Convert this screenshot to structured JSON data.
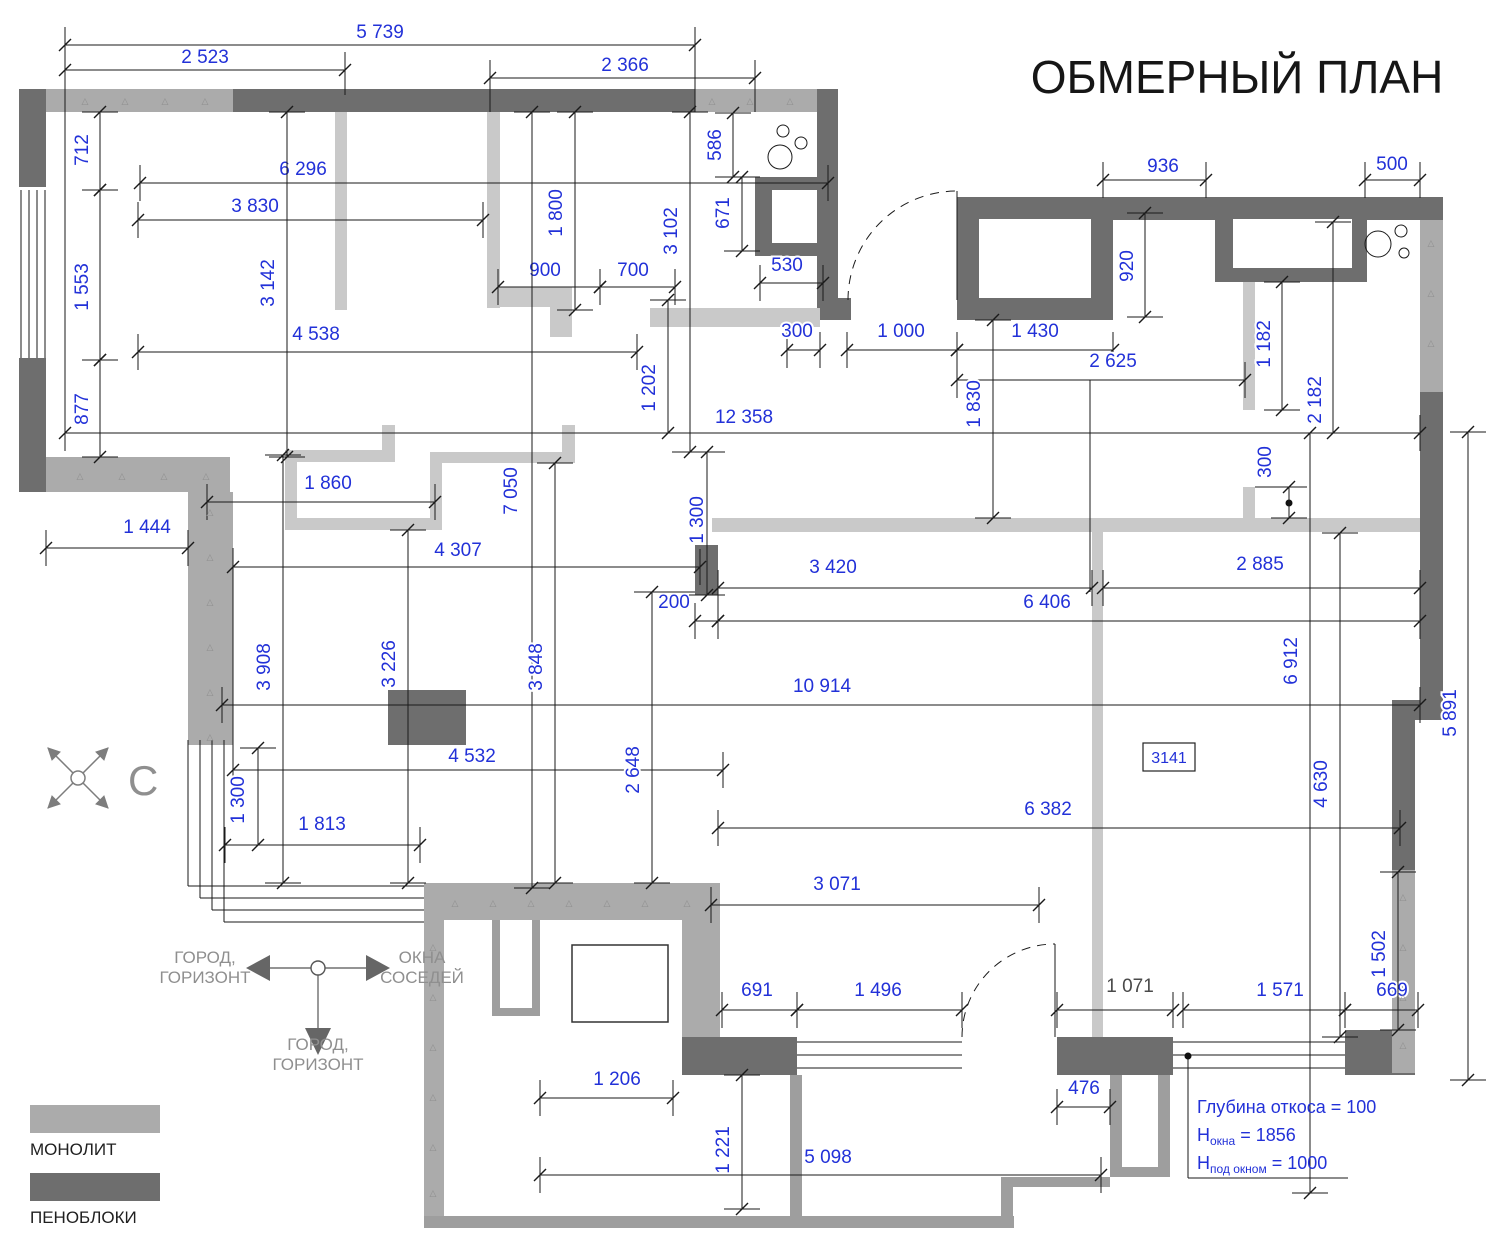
{
  "title": "ОБМЕРНЫЙ ПЛАН",
  "compass": {
    "north_label": "С"
  },
  "orientation_symbol": {
    "left_label_line1": "ГОРОД,",
    "left_label_line2": "ГОРИЗОНТ",
    "right_label_line1": "ОКНА",
    "right_label_line2": "СОСЕДЕЙ",
    "bottom_label_line1": "ГОРОД,",
    "bottom_label_line2": "ГОРИЗОНТ"
  },
  "legend": {
    "monolith_label": "МОНОЛИТ",
    "foamblock_label": "ПЕНОБЛОКИ"
  },
  "room_tag": "3141",
  "notes": [
    {
      "pre": "Глубина откоса = 100",
      "sub": "",
      "post": ""
    },
    {
      "pre": "Н",
      "sub": "окна",
      "post": " = 1856"
    },
    {
      "pre": "Н",
      "sub": "под окном",
      "post": " = 1000"
    }
  ],
  "colors": {
    "dimension_blue": "#2231d8",
    "dark_dim": "#4a4a4a",
    "monolith_gray": "#ababab",
    "foam_gray": "#6e6e6e",
    "partition_gray": "#c9c9c9",
    "balcony_gray": "#9e9e9e",
    "symbol_gray": "#8f8f8f"
  },
  "dimensions": [
    {
      "t": "5 739",
      "x1": 65,
      "y1": 45,
      "x2": 695,
      "y2": 45,
      "tx": 380,
      "ty": 38,
      "r": 0
    },
    {
      "t": "2 523",
      "x1": 65,
      "y1": 70,
      "x2": 345,
      "y2": 70,
      "tx": 205,
      "ty": 63,
      "r": 0
    },
    {
      "t": "2 366",
      "x1": 490,
      "y1": 78,
      "x2": 755,
      "y2": 78,
      "tx": 625,
      "ty": 71,
      "r": 0
    },
    {
      "t": "6 296",
      "x1": 140,
      "y1": 183,
      "x2": 828,
      "y2": 183,
      "tx": 303,
      "ty": 175,
      "r": 0
    },
    {
      "t": "3 830",
      "x1": 138,
      "y1": 220,
      "x2": 483,
      "y2": 220,
      "tx": 255,
      "ty": 212,
      "r": 0
    },
    {
      "t": "936",
      "x1": 1103,
      "y1": 180,
      "x2": 1206,
      "y2": 180,
      "tx": 1163,
      "ty": 172,
      "r": 0
    },
    {
      "t": "500",
      "x1": 1365,
      "y1": 180,
      "x2": 1420,
      "y2": 180,
      "tx": 1392,
      "ty": 170,
      "r": 0
    },
    {
      "t": "900",
      "x1": 498,
      "y1": 287,
      "x2": 600,
      "y2": 287,
      "tx": 545,
      "ty": 276,
      "r": 0
    },
    {
      "t": "700",
      "x1": 600,
      "y1": 287,
      "x2": 675,
      "y2": 287,
      "tx": 633,
      "ty": 276,
      "r": 0
    },
    {
      "t": "530",
      "x1": 760,
      "y1": 283,
      "x2": 823,
      "y2": 283,
      "tx": 787,
      "ty": 271,
      "r": 0
    },
    {
      "t": "4 538",
      "x1": 138,
      "y1": 352,
      "x2": 637,
      "y2": 352,
      "tx": 316,
      "ty": 340,
      "r": 0
    },
    {
      "t": "300",
      "x1": 787,
      "y1": 350,
      "x2": 820,
      "y2": 350,
      "tx": 797,
      "ty": 337,
      "r": 0
    },
    {
      "t": "1 000",
      "x1": 847,
      "y1": 350,
      "x2": 957,
      "y2": 350,
      "tx": 901,
      "ty": 337,
      "r": 0
    },
    {
      "t": "1 430",
      "x1": 957,
      "y1": 350,
      "x2": 1113,
      "y2": 350,
      "tx": 1035,
      "ty": 337,
      "r": 0
    },
    {
      "t": "2 625",
      "x1": 957,
      "y1": 380,
      "x2": 1245,
      "y2": 380,
      "tx": 1113,
      "ty": 367,
      "r": 0
    },
    {
      "t": "12 358",
      "x1": 65,
      "y1": 433,
      "x2": 1420,
      "y2": 433,
      "tx": 744,
      "ty": 423,
      "r": 0
    },
    {
      "t": "1 860",
      "x1": 207,
      "y1": 502,
      "x2": 435,
      "y2": 502,
      "tx": 328,
      "ty": 489,
      "r": 0
    },
    {
      "t": "1 444",
      "x1": 46,
      "y1": 548,
      "x2": 188,
      "y2": 548,
      "tx": 147,
      "ty": 533,
      "r": 0
    },
    {
      "t": "4 307",
      "x1": 233,
      "y1": 567,
      "x2": 700,
      "y2": 567,
      "tx": 458,
      "ty": 556,
      "r": 0
    },
    {
      "t": "3 420",
      "x1": 718,
      "y1": 588,
      "x2": 1092,
      "y2": 588,
      "tx": 833,
      "ty": 573,
      "r": 0
    },
    {
      "t": "2 885",
      "x1": 1103,
      "y1": 588,
      "x2": 1420,
      "y2": 588,
      "tx": 1260,
      "ty": 570,
      "r": 0
    },
    {
      "t": "200",
      "x1": 695,
      "y1": 621,
      "x2": 718,
      "y2": 621,
      "tx": 674,
      "ty": 608,
      "r": 0
    },
    {
      "t": "6 406",
      "x1": 718,
      "y1": 621,
      "x2": 1420,
      "y2": 621,
      "tx": 1047,
      "ty": 608,
      "r": 0
    },
    {
      "t": "10 914",
      "x1": 222,
      "y1": 705,
      "x2": 1420,
      "y2": 705,
      "tx": 822,
      "ty": 692,
      "r": 0
    },
    {
      "t": "4 532",
      "x1": 233,
      "y1": 770,
      "x2": 723,
      "y2": 770,
      "tx": 472,
      "ty": 762,
      "r": 0
    },
    {
      "t": "6 382",
      "x1": 718,
      "y1": 828,
      "x2": 1400,
      "y2": 828,
      "tx": 1048,
      "ty": 815,
      "r": 0
    },
    {
      "t": "1 813",
      "x1": 225,
      "y1": 845,
      "x2": 420,
      "y2": 845,
      "tx": 322,
      "ty": 830,
      "r": 0
    },
    {
      "t": "3 071",
      "x1": 711,
      "y1": 905,
      "x2": 1039,
      "y2": 905,
      "tx": 837,
      "ty": 890,
      "r": 0
    },
    {
      "t": "691",
      "x1": 722,
      "y1": 1010,
      "x2": 797,
      "y2": 1010,
      "tx": 757,
      "ty": 996,
      "r": 0
    },
    {
      "t": "1 496",
      "x1": 797,
      "y1": 1010,
      "x2": 962,
      "y2": 1010,
      "tx": 878,
      "ty": 996,
      "r": 0
    },
    {
      "t": "1 071",
      "x1": 1057,
      "y1": 1010,
      "x2": 1173,
      "y2": 1010,
      "tx": 1130,
      "ty": 992,
      "r": 0,
      "d": 1
    },
    {
      "t": "1 571",
      "x1": 1183,
      "y1": 1010,
      "x2": 1345,
      "y2": 1010,
      "tx": 1280,
      "ty": 996,
      "r": 0
    },
    {
      "t": "669",
      "x1": 1345,
      "y1": 1010,
      "x2": 1418,
      "y2": 1010,
      "tx": 1392,
      "ty": 996,
      "r": 0
    },
    {
      "t": "1 206",
      "x1": 540,
      "y1": 1098,
      "x2": 673,
      "y2": 1098,
      "tx": 617,
      "ty": 1085,
      "r": 0
    },
    {
      "t": "476",
      "x1": 1057,
      "y1": 1107,
      "x2": 1110,
      "y2": 1107,
      "tx": 1084,
      "ty": 1094,
      "r": 0
    },
    {
      "t": "5 098",
      "x1": 540,
      "y1": 1175,
      "x2": 1101,
      "y2": 1175,
      "tx": 828,
      "ty": 1163,
      "r": 0
    },
    {
      "t": "712",
      "x1": 100,
      "y1": 112,
      "x2": 100,
      "y2": 190,
      "tx": 88,
      "ty": 150,
      "r": 1
    },
    {
      "t": "1 553",
      "x1": 100,
      "y1": 190,
      "x2": 100,
      "y2": 360,
      "tx": 88,
      "ty": 287,
      "r": 1
    },
    {
      "t": "877",
      "x1": 100,
      "y1": 360,
      "x2": 100,
      "y2": 457,
      "tx": 88,
      "ty": 409,
      "r": 1
    },
    {
      "t": "3 142",
      "x1": 287,
      "y1": 112,
      "x2": 287,
      "y2": 457,
      "tx": 274,
      "ty": 283,
      "r": 1
    },
    {
      "t": "1 800",
      "x1": 575,
      "y1": 112,
      "x2": 575,
      "y2": 310,
      "tx": 562,
      "ty": 213,
      "r": 1
    },
    {
      "t": "3 102",
      "x1": 690,
      "y1": 112,
      "x2": 690,
      "y2": 452,
      "tx": 677,
      "ty": 231,
      "r": 1
    },
    {
      "t": "586",
      "x1": 733,
      "y1": 113,
      "x2": 733,
      "y2": 177,
      "tx": 721,
      "ty": 145,
      "r": 1
    },
    {
      "t": "671",
      "x1": 742,
      "y1": 177,
      "x2": 742,
      "y2": 251,
      "tx": 729,
      "ty": 213,
      "r": 1
    },
    {
      "t": "920",
      "x1": 1145,
      "y1": 213,
      "x2": 1145,
      "y2": 317,
      "tx": 1133,
      "ty": 266,
      "r": 1
    },
    {
      "t": "1 182",
      "x1": 1282,
      "y1": 282,
      "x2": 1282,
      "y2": 410,
      "tx": 1270,
      "ty": 344,
      "r": 1
    },
    {
      "t": "2 182",
      "x1": 1333,
      "y1": 222,
      "x2": 1333,
      "y2": 433,
      "tx": 1321,
      "ty": 400,
      "r": 1
    },
    {
      "t": "1 830",
      "x1": 993,
      "y1": 320,
      "x2": 993,
      "y2": 518,
      "tx": 980,
      "ty": 404,
      "r": 1
    },
    {
      "t": "1 202",
      "x1": 668,
      "y1": 300,
      "x2": 668,
      "y2": 433,
      "tx": 655,
      "ty": 388,
      "r": 1
    },
    {
      "t": "7 050",
      "x1": 532,
      "y1": 112,
      "x2": 532,
      "y2": 888,
      "tx": 517,
      "ty": 491,
      "r": 1
    },
    {
      "t": "1 300",
      "x1": 707,
      "y1": 452,
      "x2": 707,
      "y2": 595,
      "tx": 703,
      "ty": 520,
      "r": 1
    },
    {
      "t": "300",
      "x1": 1289,
      "y1": 487,
      "x2": 1289,
      "y2": 518,
      "tx": 1271,
      "ty": 462,
      "r": 1
    },
    {
      "t": "3 908",
      "x1": 283,
      "y1": 455,
      "x2": 283,
      "y2": 883,
      "tx": 270,
      "ty": 667,
      "r": 1
    },
    {
      "t": "3 226",
      "x1": 408,
      "y1": 530,
      "x2": 408,
      "y2": 883,
      "tx": 395,
      "ty": 664,
      "r": 1
    },
    {
      "t": "3 848",
      "x1": 555,
      "y1": 463,
      "x2": 555,
      "y2": 883,
      "tx": 542,
      "ty": 667,
      "r": 1
    },
    {
      "t": "2 648",
      "x1": 652,
      "y1": 592,
      "x2": 652,
      "y2": 883,
      "tx": 639,
      "ty": 770,
      "r": 1
    },
    {
      "t": "1 300",
      "x1": 258,
      "y1": 748,
      "x2": 258,
      "y2": 845,
      "tx": 244,
      "ty": 800,
      "r": 1
    },
    {
      "t": "6 912",
      "x1": 1310,
      "y1": 433,
      "x2": 1310,
      "y2": 1193,
      "tx": 1297,
      "ty": 661,
      "r": 1
    },
    {
      "t": "4 630",
      "x1": 1340,
      "y1": 533,
      "x2": 1340,
      "y2": 1037,
      "tx": 1327,
      "ty": 784,
      "r": 1
    },
    {
      "t": "5 891",
      "x1": 1468,
      "y1": 432,
      "x2": 1468,
      "y2": 1080,
      "tx": 1456,
      "ty": 713,
      "r": 1
    },
    {
      "t": "1 502",
      "x1": 1398,
      "y1": 872,
      "x2": 1398,
      "y2": 1030,
      "tx": 1385,
      "ty": 954,
      "r": 1
    },
    {
      "t": "1 221",
      "x1": 742,
      "y1": 1075,
      "x2": 742,
      "y2": 1209,
      "tx": 729,
      "ty": 1150,
      "r": 1
    }
  ]
}
